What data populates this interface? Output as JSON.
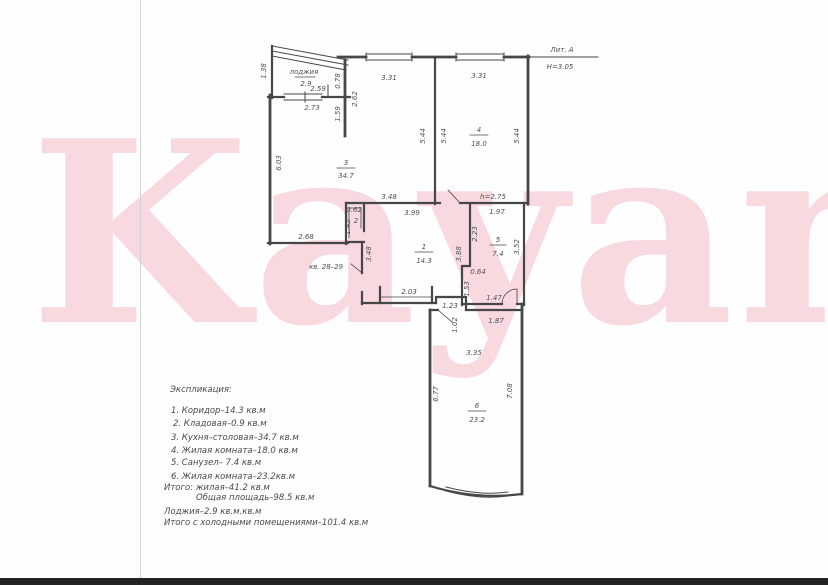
{
  "page": {
    "watermark": "Kayan",
    "lit_label": "Лит. А",
    "height_label": "Н=3.05"
  },
  "rooms": {
    "r1": {
      "num": "1",
      "area": "14.3"
    },
    "r2": {
      "num": "2"
    },
    "r3": {
      "num": "3",
      "area": "34.7"
    },
    "r4": {
      "num": "4",
      "area": "18.0"
    },
    "r5": {
      "num": "5",
      "area": "7.4"
    },
    "r6": {
      "num": "6",
      "area": "23.2"
    },
    "loggia": {
      "name": "лоджия",
      "area": "2.9"
    }
  },
  "notes": {
    "neighbor": "кв. 28–29",
    "ceiling": "h=2.75"
  },
  "dims": {
    "loggia_left_h": "1.38",
    "loggia_w": "2.59",
    "loggia_right_h": "0.78",
    "kitchen_top_w": "2.73",
    "stub_inner_h": "1.59",
    "stub_outer_h": "2.62",
    "kitchen_window_w": "3.31",
    "room4_window_w": "3.31",
    "kitchen_left_h": "6.03",
    "kitchen_right_h": "5.44",
    "room4_left_h": "5.44",
    "room4_right_h": "5.44",
    "kitchen_bottom_w": "3.48",
    "kitchen_bottom_left_w": "2.68",
    "pantry_w": "0.62",
    "pantry_h": "1.45",
    "corridor_top_w": "3.99",
    "corridor_left_h": "3.48",
    "corridor_right_h": "3.88",
    "corridor_bottom_w": "2.03",
    "bath_top_w": "1.97",
    "bath_left_h": "2.23",
    "bath_right_h": "3.52",
    "bath_jog_w": "0.64",
    "bath_left_h2": "1.53",
    "bath_bottom_w": "1.47",
    "hall_w": "1.23",
    "hall_door_w": "1.02",
    "room6_top_w": "1.87",
    "room6_mid_w": "3.35",
    "room6_left_h": "6.77",
    "room6_right_h": "7.08"
  },
  "legend": {
    "title": "Экспликация:",
    "items": [
      "1. Коридор–14.3 кв.м",
      "2. Кладовая–0.9 кв.м",
      "3. Кухня–столовая–34.7 кв.м",
      "4. Жилая комната–18.0 кв.м",
      "5. Санузел– 7.4 кв.м",
      "6. Жилая комната–23.2кв.м"
    ],
    "totals": [
      "Итого: жилая–41.2 кв.м",
      "Общая площадь–98.5 кв.м",
      "Лоджия–2.9 кв.м.кв.м",
      "Итого с холодными помещениями–101.4 кв.м"
    ]
  }
}
